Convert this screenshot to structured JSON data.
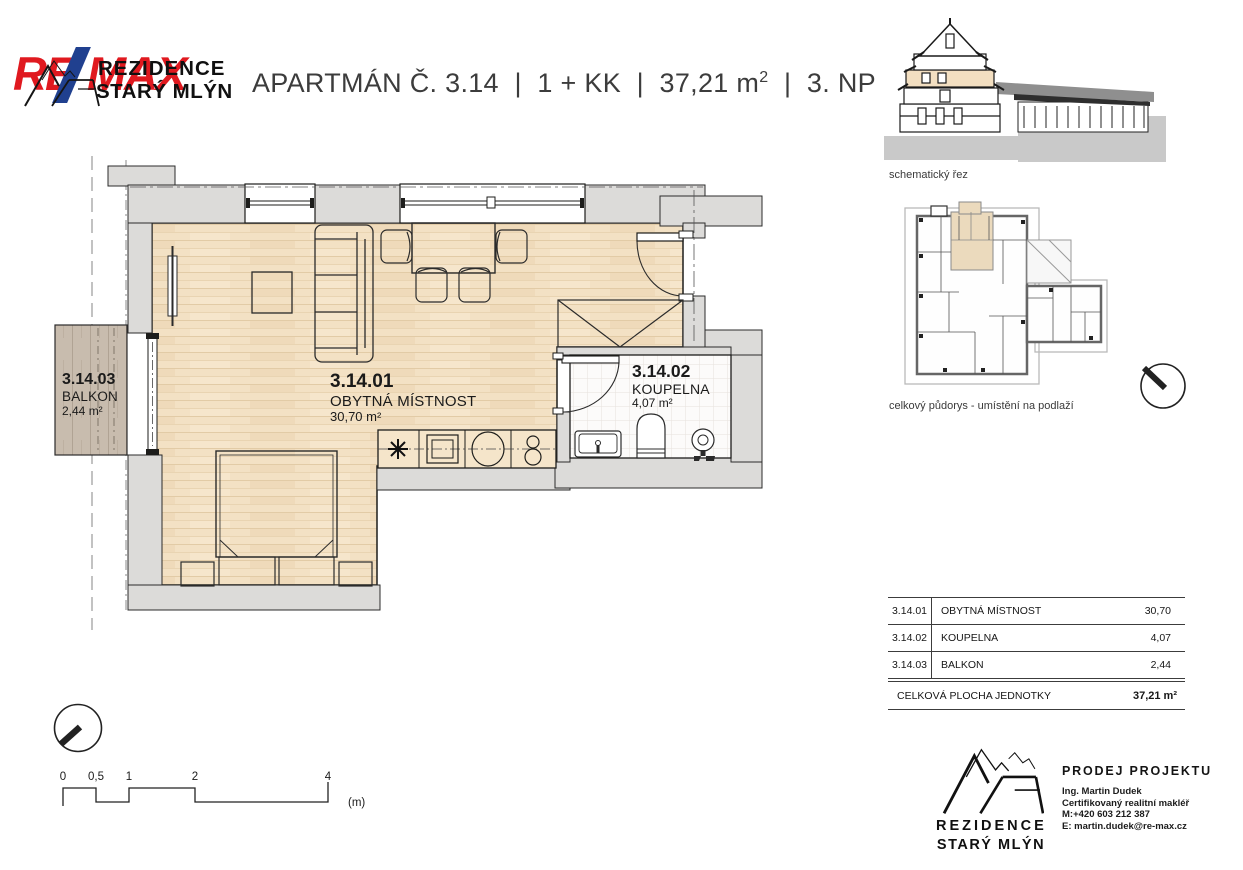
{
  "colors": {
    "remax_red": "#E0191F",
    "remax_blue": "#20408F",
    "wall_gray": "#DCDBD9",
    "floor_wood": "#F3E1C4",
    "balcony_wood": "#C8BCAE",
    "unit_highlight": "#EBDABD"
  },
  "header": {
    "remax_re": "RE",
    "remax_max": "MAX",
    "brand_line1": "REZIDENCE",
    "brand_line2": "STARÝ MLÝN",
    "title_pre": "APARTMÁN Č. 3.14  |  1 + KK  |  37,21 m",
    "title_sup": "2",
    "title_post": "  |  3. NP"
  },
  "plan": {
    "living": {
      "code": "3.14.01",
      "name": "OBYTNÁ MÍSTNOST",
      "area": "30,70 m²"
    },
    "bathroom": {
      "code": "3.14.02",
      "name": "KOUPELNA",
      "area": "4,07 m²"
    },
    "balcony": {
      "code": "3.14.03",
      "name": "BALKON",
      "area": "2,44 m²"
    }
  },
  "side": {
    "section_caption": "schematický řez",
    "floorplan_caption": "celkový půdorys - umístění na podlaží"
  },
  "area_table": {
    "rows": [
      {
        "code": "3.14.01",
        "name": "OBYTNÁ MÍSTNOST",
        "value": "30,70"
      },
      {
        "code": "3.14.02",
        "name": "KOUPELNA",
        "value": "4,07"
      },
      {
        "code": "3.14.03",
        "name": "BALKON",
        "value": "2,44"
      }
    ],
    "total_label": "CELKOVÁ PLOCHA JEDNOTKY",
    "total_value": "37,21 m²"
  },
  "scale_bar": {
    "ticks": [
      "0",
      "0,5",
      "1",
      "2",
      "4"
    ],
    "unit": "(m)"
  },
  "footer": {
    "brand_line1": "REZIDENCE",
    "brand_line2": "STARÝ MLÝN",
    "contact_heading": "PRODEJ PROJEKTU",
    "contact_name": "Ing. Martin Dudek",
    "contact_role": "Certifikovaný realitní makléř",
    "contact_phone": "M:+420 603 212 387",
    "contact_email": "E: martin.dudek@re-max.cz"
  }
}
